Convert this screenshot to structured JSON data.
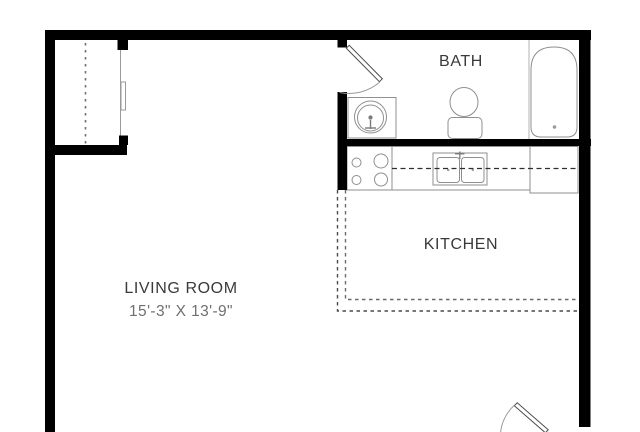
{
  "floor_plan": {
    "bath": {
      "label": "BATH"
    },
    "kitchen": {
      "label": "KITCHEN"
    },
    "living_room": {
      "label": "LIVING ROOM",
      "dimensions": "15'-3\" X 13'-9\""
    },
    "fixtures": [
      "closet-rod",
      "closet-sliding-door",
      "bath-door",
      "bathroom-sink",
      "toilet",
      "bathtub",
      "stove",
      "kitchen-sink",
      "kitchen-counter",
      "refrigerator-counter",
      "entry-door"
    ],
    "colors": {
      "wall": "#000000",
      "fixture_outline": "#8f8f8f",
      "dashed_boundary": "#4a4a4a",
      "label_text": "#3a3a3a",
      "dimension_text": "#6f6f6f",
      "background": "#ffffff"
    }
  }
}
